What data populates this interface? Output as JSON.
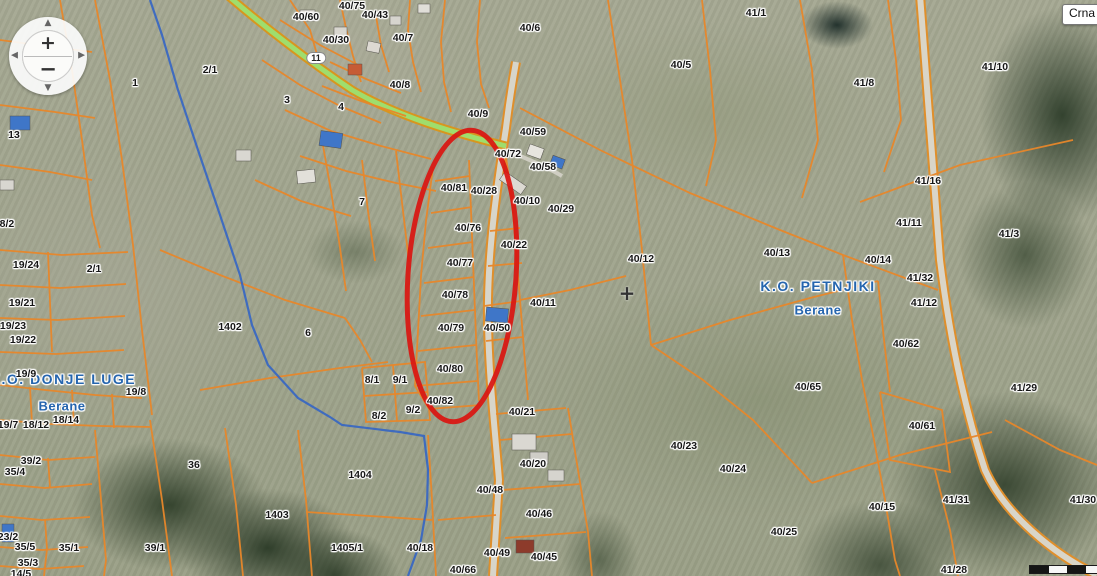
{
  "overlays": {
    "region_tooltip": "Crna",
    "crosshair_glyph": "+"
  },
  "controls": {
    "zoom_in": "+",
    "zoom_out": "−",
    "pan_up": "▲",
    "pan_left": "◀",
    "pan_right": "▶",
    "pan_down": "▼"
  },
  "colors": {
    "parcel_line": "#e8872a",
    "municipal_boundary": "#2e62c8",
    "highlight": "#da1510",
    "place_text": "#2565ae",
    "road_green": "#9fdd6d",
    "road_gray": "#d7d5ca"
  },
  "map": {
    "municipalities": [
      {
        "t": "K.O. DONJE LUGE",
        "x": 63,
        "y": 379,
        "kind": "muni"
      },
      {
        "t": "Berane",
        "x": 62,
        "y": 406,
        "kind": "place"
      },
      {
        "t": "K.O. PETNJIKI",
        "x": 818,
        "y": 286,
        "kind": "muni"
      },
      {
        "t": "Berane",
        "x": 818,
        "y": 310,
        "kind": "place"
      }
    ],
    "parcel_labels": [
      {
        "t": "40/75",
        "x": 352,
        "y": 6
      },
      {
        "t": "40/60",
        "x": 306,
        "y": 17
      },
      {
        "t": "40/43",
        "x": 375,
        "y": 15
      },
      {
        "t": "40/30",
        "x": 336,
        "y": 40
      },
      {
        "t": "40/7",
        "x": 403,
        "y": 38
      },
      {
        "t": "11",
        "x": 316,
        "y": 58,
        "kind": "road"
      },
      {
        "t": "2/1",
        "x": 210,
        "y": 70
      },
      {
        "t": "1",
        "x": 135,
        "y": 83
      },
      {
        "t": "3",
        "x": 287,
        "y": 100
      },
      {
        "t": "4",
        "x": 341,
        "y": 107
      },
      {
        "t": "40/8",
        "x": 400,
        "y": 85
      },
      {
        "t": "40/9",
        "x": 478,
        "y": 114
      },
      {
        "t": "13",
        "x": 14,
        "y": 135
      },
      {
        "t": "18/2",
        "x": 4,
        "y": 224
      },
      {
        "t": "19/24",
        "x": 26,
        "y": 265
      },
      {
        "t": "2/1",
        "x": 94,
        "y": 269
      },
      {
        "t": "19/21",
        "x": 22,
        "y": 303
      },
      {
        "t": "19/23",
        "x": 13,
        "y": 326
      },
      {
        "t": "19/22",
        "x": 23,
        "y": 340
      },
      {
        "t": "1402",
        "x": 230,
        "y": 327
      },
      {
        "t": "6",
        "x": 308,
        "y": 333
      },
      {
        "t": "7",
        "x": 362,
        "y": 202
      },
      {
        "t": "19/9",
        "x": 26,
        "y": 374
      },
      {
        "t": "19/8",
        "x": 136,
        "y": 392
      },
      {
        "t": "18/14",
        "x": 66,
        "y": 420
      },
      {
        "t": "19/7",
        "x": 8,
        "y": 425
      },
      {
        "t": "18/12",
        "x": 36,
        "y": 425
      },
      {
        "t": "39/2",
        "x": 31,
        "y": 461
      },
      {
        "t": "35/4",
        "x": 15,
        "y": 472
      },
      {
        "t": "36",
        "x": 194,
        "y": 465
      },
      {
        "t": "23/2",
        "x": 8,
        "y": 537
      },
      {
        "t": "35/5",
        "x": 25,
        "y": 547
      },
      {
        "t": "35/1",
        "x": 69,
        "y": 548
      },
      {
        "t": "35/3",
        "x": 28,
        "y": 563
      },
      {
        "t": "14/5",
        "x": 21,
        "y": 574
      },
      {
        "t": "39/1",
        "x": 155,
        "y": 548
      },
      {
        "t": "1404",
        "x": 360,
        "y": 475
      },
      {
        "t": "1403",
        "x": 277,
        "y": 515
      },
      {
        "t": "1405/1",
        "x": 347,
        "y": 548
      },
      {
        "t": "40/18",
        "x": 420,
        "y": 548
      },
      {
        "t": "40/66",
        "x": 463,
        "y": 570
      },
      {
        "t": "40/49",
        "x": 497,
        "y": 553
      },
      {
        "t": "40/45",
        "x": 544,
        "y": 557
      },
      {
        "t": "40/46",
        "x": 539,
        "y": 514
      },
      {
        "t": "40/48",
        "x": 490,
        "y": 490
      },
      {
        "t": "40/20",
        "x": 533,
        "y": 464
      },
      {
        "t": "40/21",
        "x": 522,
        "y": 412
      },
      {
        "t": "8/1",
        "x": 372,
        "y": 380
      },
      {
        "t": "9/1",
        "x": 400,
        "y": 380
      },
      {
        "t": "8/2",
        "x": 379,
        "y": 416
      },
      {
        "t": "9/2",
        "x": 413,
        "y": 410
      },
      {
        "t": "40/82",
        "x": 440,
        "y": 401
      },
      {
        "t": "40/80",
        "x": 450,
        "y": 369
      },
      {
        "t": "40/79",
        "x": 451,
        "y": 328
      },
      {
        "t": "40/50",
        "x": 497,
        "y": 328
      },
      {
        "t": "40/78",
        "x": 455,
        "y": 295
      },
      {
        "t": "40/77",
        "x": 460,
        "y": 263
      },
      {
        "t": "40/76",
        "x": 468,
        "y": 228
      },
      {
        "t": "40/11",
        "x": 543,
        "y": 303
      },
      {
        "t": "40/22",
        "x": 514,
        "y": 245
      },
      {
        "t": "40/81",
        "x": 454,
        "y": 188
      },
      {
        "t": "40/28",
        "x": 484,
        "y": 191
      },
      {
        "t": "40/10",
        "x": 527,
        "y": 201
      },
      {
        "t": "40/29",
        "x": 561,
        "y": 209
      },
      {
        "t": "40/72",
        "x": 508,
        "y": 154
      },
      {
        "t": "40/59",
        "x": 533,
        "y": 132
      },
      {
        "t": "40/58",
        "x": 543,
        "y": 167
      },
      {
        "t": "40/6",
        "x": 530,
        "y": 28
      },
      {
        "t": "40/5",
        "x": 681,
        "y": 65
      },
      {
        "t": "41/1",
        "x": 756,
        "y": 13
      },
      {
        "t": "41/8",
        "x": 864,
        "y": 83
      },
      {
        "t": "41/10",
        "x": 995,
        "y": 67
      },
      {
        "t": "40/12",
        "x": 641,
        "y": 259
      },
      {
        "t": "40/13",
        "x": 777,
        "y": 253
      },
      {
        "t": "40/14",
        "x": 878,
        "y": 260
      },
      {
        "t": "41/16",
        "x": 928,
        "y": 181
      },
      {
        "t": "41/11",
        "x": 909,
        "y": 223
      },
      {
        "t": "41/3",
        "x": 1009,
        "y": 234
      },
      {
        "t": "41/32",
        "x": 920,
        "y": 278
      },
      {
        "t": "41/12",
        "x": 924,
        "y": 303
      },
      {
        "t": "40/62",
        "x": 906,
        "y": 344
      },
      {
        "t": "40/65",
        "x": 808,
        "y": 387
      },
      {
        "t": "40/23",
        "x": 684,
        "y": 446
      },
      {
        "t": "40/24",
        "x": 733,
        "y": 469
      },
      {
        "t": "40/25",
        "x": 784,
        "y": 532
      },
      {
        "t": "40/15",
        "x": 882,
        "y": 507
      },
      {
        "t": "40/61",
        "x": 922,
        "y": 426
      },
      {
        "t": "41/31",
        "x": 956,
        "y": 500
      },
      {
        "t": "41/29",
        "x": 1024,
        "y": 388
      },
      {
        "t": "41/30",
        "x": 1083,
        "y": 500
      },
      {
        "t": "41/28",
        "x": 954,
        "y": 570
      }
    ],
    "highlight_ellipse": {
      "cx": 462,
      "cy": 276,
      "rx": 54,
      "ry": 146,
      "rotation": 4
    }
  }
}
